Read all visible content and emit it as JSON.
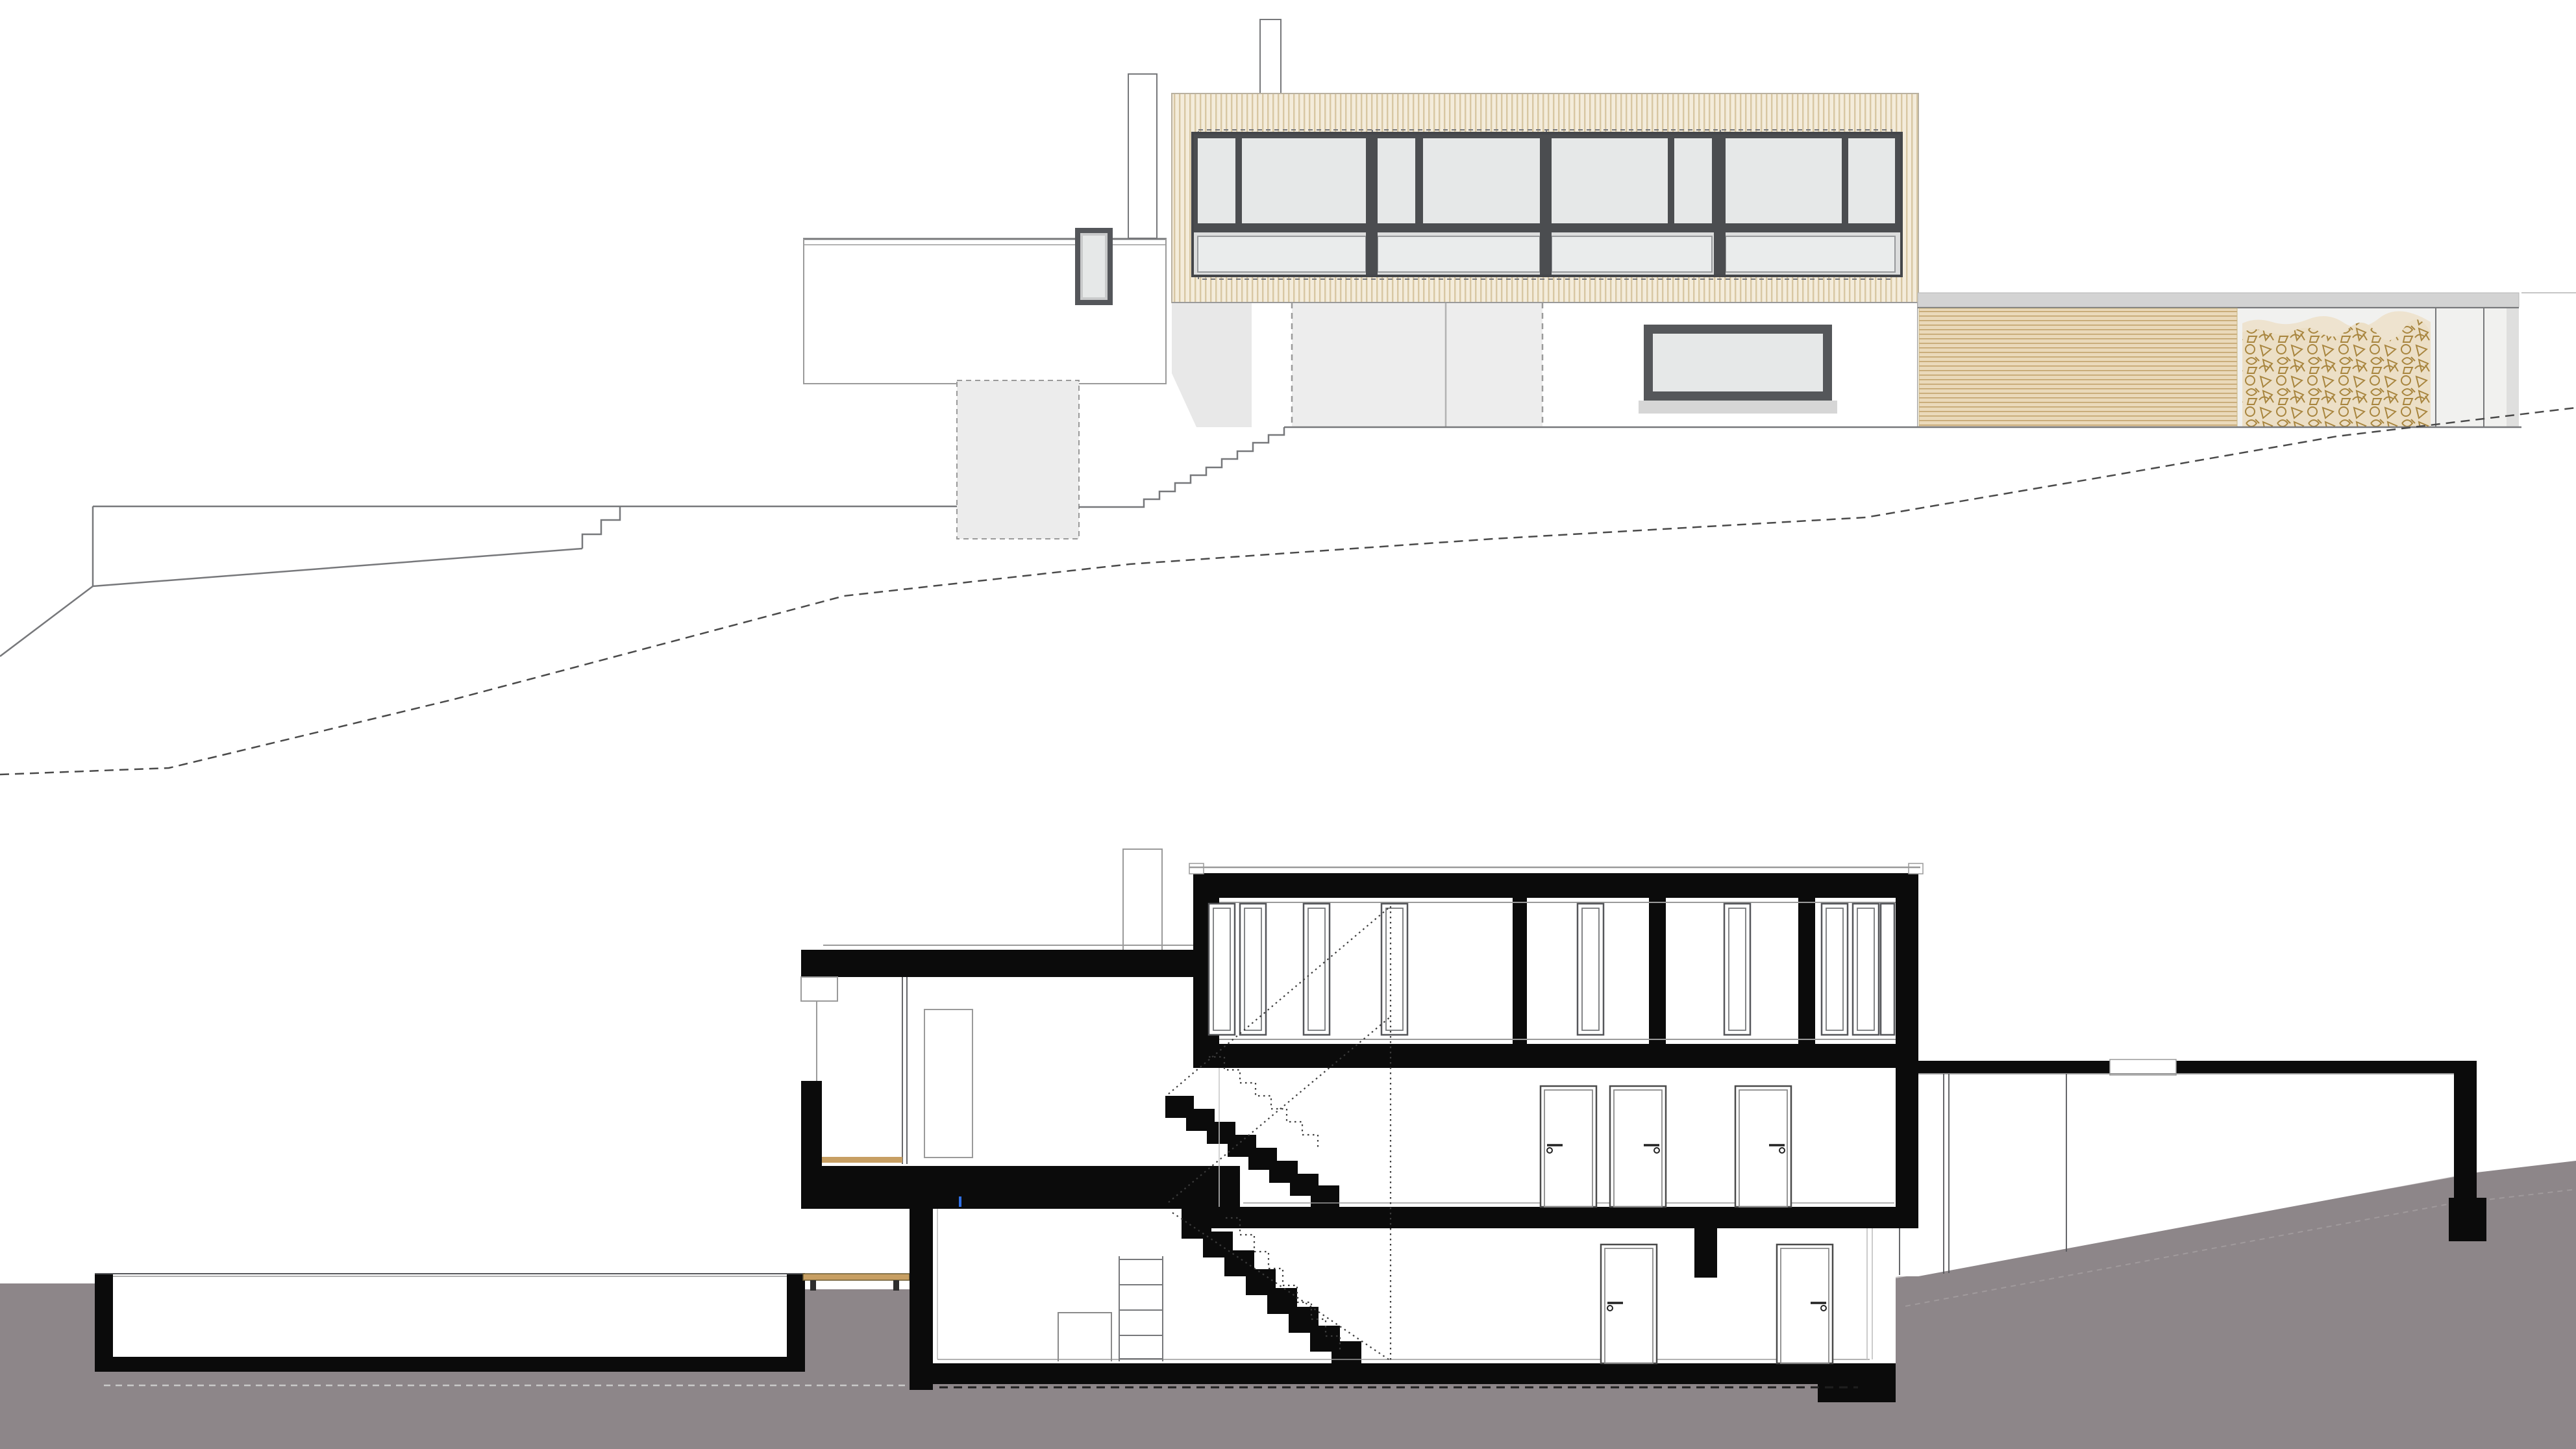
{
  "document": {
    "kind": "architectural-drawing",
    "views": [
      {
        "id": "elevation",
        "role": "building-elevation-with-terrain"
      },
      {
        "id": "section",
        "role": "longitudinal-building-section"
      }
    ]
  },
  "colors": {
    "bg": "#ffffff",
    "black": "#0b0b0b",
    "ground_gray": "#8d8689",
    "ground_lip": "#c9c5c6",
    "line_dark": "#3f4043",
    "line_mid": "#77787b",
    "line_soft": "#9a9a9a",
    "line_faint": "#c6c6c6",
    "shadow_gray": "#e8e8e8",
    "pier_gray": "#ededed",
    "cellar_gray": "#ececec",
    "facade_gray": "#f1f1ef",
    "roofband_gray": "#d3d3d3",
    "sideband_gray": "#dfdfde",
    "frame_dark": "#4b4d50",
    "frame_soft": "#97999b",
    "glass": "#e6e8e8",
    "glass_light": "#eaecec",
    "spandrel_band": "#dcdddd",
    "sill_gray": "#d6d6d6",
    "beige_fill": "#f4ecdb",
    "beige_stripe": "#d8c7a3",
    "beige_border": "#b9b1a0",
    "slat_fill": "#ead9ba",
    "slat_line": "#c2a36c",
    "wood_fill": "#ecdfc6",
    "wood_back": "#eee3cf",
    "wood_line": "#a8853e",
    "deck_tan": "#c79f63",
    "deck_edge": "#6b5b33",
    "dash_dark": "#1f1f1f",
    "dash_terrain": "#4a4a4a",
    "blue_mark": "#2f6fe4",
    "white": "#ffffff"
  }
}
